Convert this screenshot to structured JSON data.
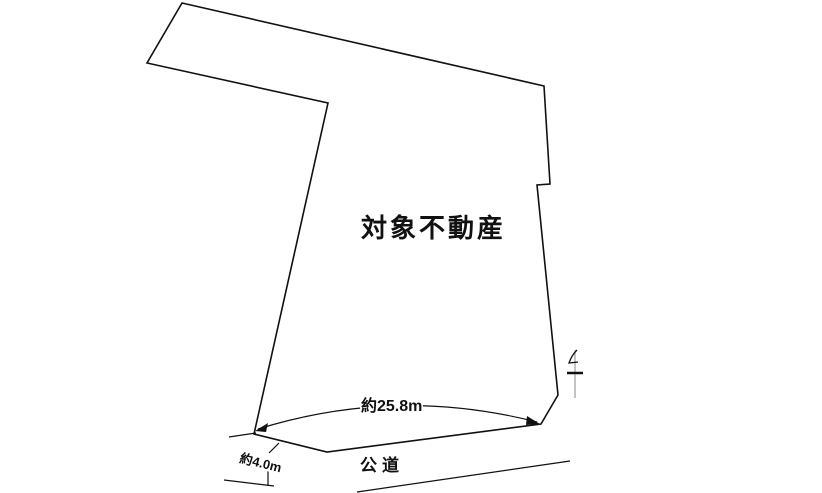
{
  "diagram": {
    "property_label": "対象不動産",
    "frontage_dimension": "約25.8m",
    "road_width_dimension": "約4.0m",
    "road_label": "公道",
    "colors": {
      "background": "#ffffff",
      "line": "#111111",
      "pole_line": "#888888"
    }
  }
}
